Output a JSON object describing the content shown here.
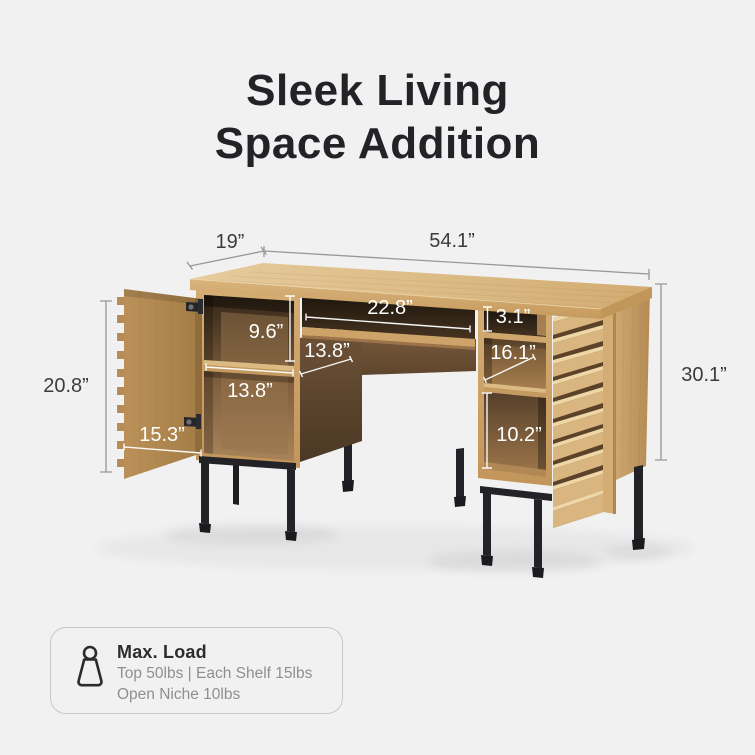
{
  "title": {
    "line1": "Sleek Living",
    "line2": "Space Addition"
  },
  "dimensions": {
    "depth": "19”",
    "width": "54.1”",
    "left_opening_height": "20.8”",
    "overall_height": "30.1”",
    "upper_shelf_height": "9.6”",
    "lower_shelf_width": "13.8”",
    "body_depth": "13.8”",
    "door_width": "15.3”",
    "tray_width": "22.8”",
    "top_niche_height": "3.1”",
    "middle_depth": "16.1”",
    "lower_right_height": "10.2”"
  },
  "max_load": {
    "heading": "Max. Load",
    "line1": "Top 50lbs | Each Shelf 15lbs",
    "line2": "Open Niche 10lbs"
  },
  "colors": {
    "background": "#f1f1f2",
    "wood_light": "#dcba84",
    "wood_mid": "#c79c63",
    "walnut": "#6f5236",
    "metal_black": "#232327",
    "dimension_gray": "#97979a",
    "dimension_dark_text": "#3c3c3f",
    "dimension_white": "#ffffff"
  }
}
